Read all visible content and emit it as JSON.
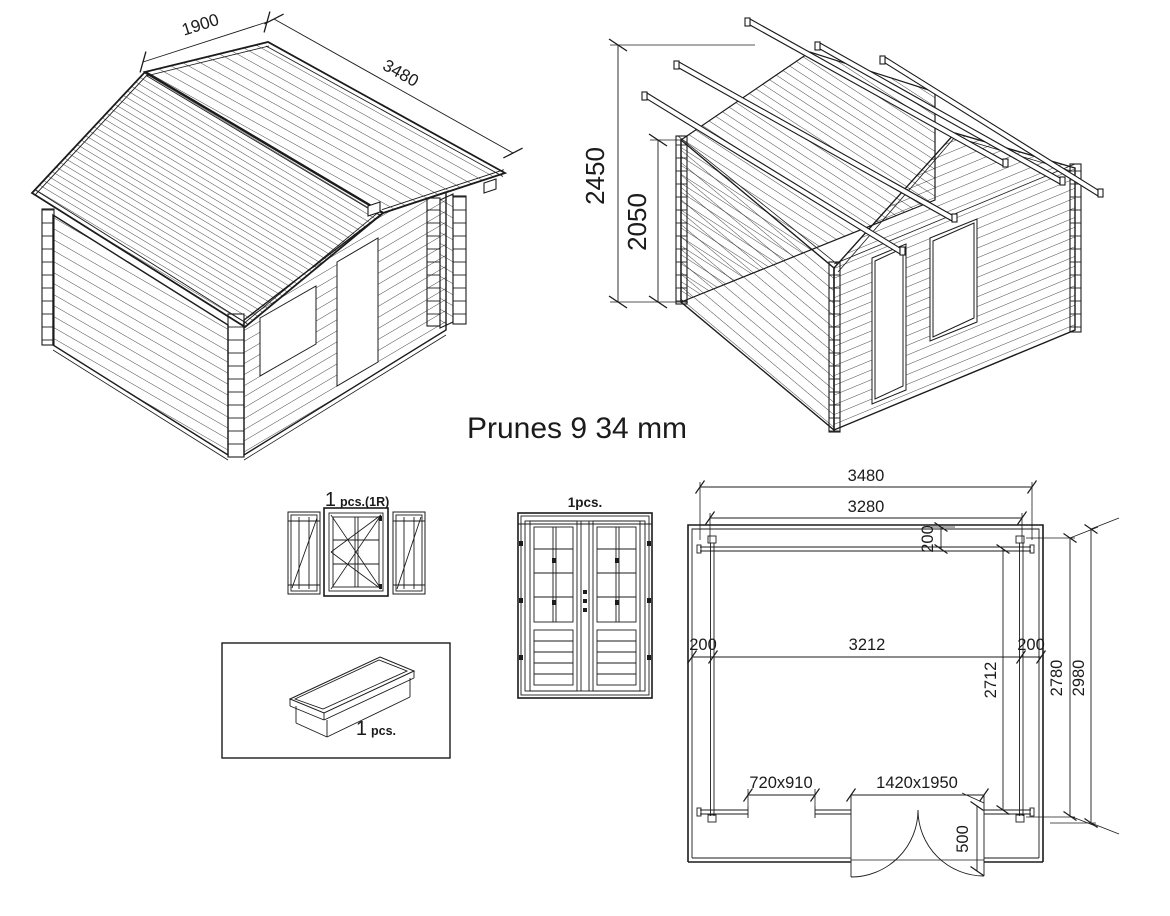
{
  "title": "Prunes 9 34 mm",
  "iso_cabin": {
    "dim_slope": "1900",
    "dim_length": "3480"
  },
  "iso_frame": {
    "dim_total_height": "2450",
    "dim_wall_height": "2050"
  },
  "window_detail": {
    "qty_big": "1",
    "qty_small": "pcs.(1R)"
  },
  "flower_box": {
    "qty_big": "1",
    "qty_small": "pcs."
  },
  "door_detail": {
    "qty": "1pcs."
  },
  "floor_plan": {
    "width_overall": "3480",
    "width_inner": "3280",
    "beam_offset": "200",
    "inner_span": "3212",
    "margin_left": "200",
    "margin_right": "200",
    "depth_post": "2712",
    "depth_mid": "2780",
    "depth_overall": "2980",
    "door_side_offset": "500",
    "window_opening": "720x910",
    "door_opening": "1420x1950"
  }
}
